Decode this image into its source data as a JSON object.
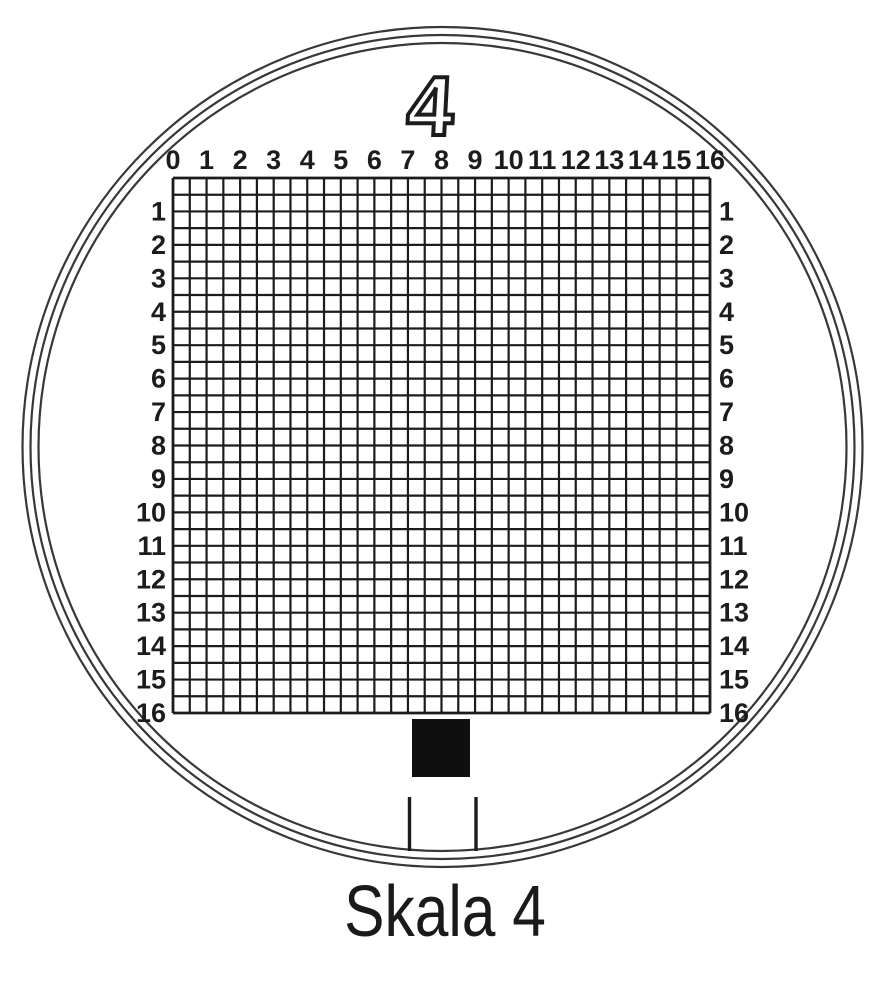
{
  "figure": {
    "type": "magnifier-measuring-reticle",
    "scale_number": "4",
    "caption": "Skala 4",
    "grid": {
      "columns": 32,
      "rows": 32,
      "minor_cells_per_label": 2,
      "label_range": [
        0,
        16
      ],
      "top_labels": [
        "0",
        "1",
        "2",
        "3",
        "4",
        "5",
        "6",
        "7",
        "8",
        "9",
        "10",
        "11",
        "12",
        "13",
        "14",
        "15",
        "16"
      ],
      "left_labels": [
        "1",
        "2",
        "3",
        "4",
        "5",
        "6",
        "7",
        "8",
        "9",
        "10",
        "11",
        "12",
        "13",
        "14",
        "15",
        "16"
      ],
      "right_labels": [
        "1",
        "2",
        "3",
        "4",
        "5",
        "6",
        "7",
        "8",
        "9",
        "10",
        "11",
        "12",
        "13",
        "14",
        "15",
        "16"
      ]
    },
    "lens": {
      "ring_count": 3
    },
    "marker": {
      "shape": "filled-square",
      "tick_count": 2
    },
    "colors": {
      "ink": "#1c1c1c",
      "ring": "#383838",
      "square": "#0f0f0f",
      "paper": "#ffffff"
    }
  }
}
